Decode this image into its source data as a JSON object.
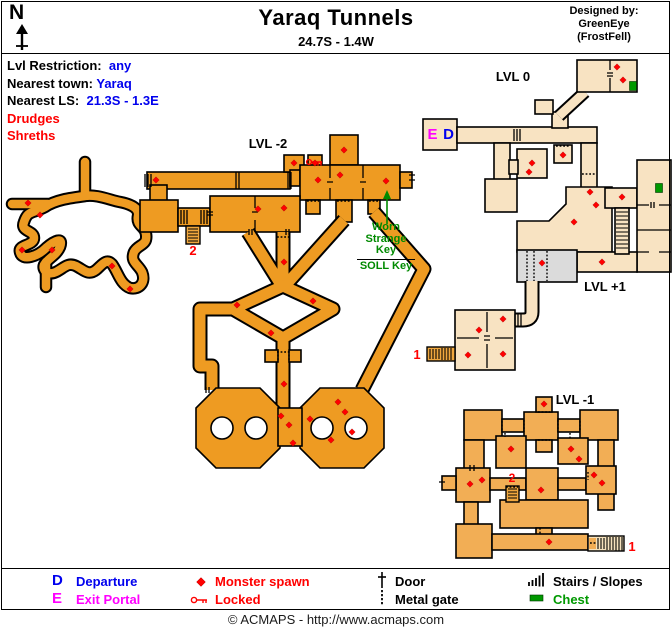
{
  "header": {
    "compass_n": "N",
    "title": "Yaraq Tunnels",
    "coordinates": "24.7S - 1.4W",
    "designed_by": "Designed by:",
    "designer_name": "GreenEye",
    "designer_world": "(FrostFell)"
  },
  "info": {
    "lvl_restriction_label": "Lvl Restriction:",
    "lvl_restriction_value": "any",
    "nearest_town_label": "Nearest town:",
    "nearest_town_value": "Yaraq",
    "nearest_ls_label": "Nearest LS:",
    "nearest_ls_value": "21.3S - 1.3E",
    "monsters": [
      "Drudges",
      "Shreths"
    ]
  },
  "map": {
    "level_labels": {
      "minus2": "LVL -2",
      "zero": "LVL 0",
      "plus1": "LVL +1",
      "minus1": "LVL -1"
    },
    "markers": {
      "exit_portal": "E",
      "departure": "D",
      "stairs_2_upper": "2",
      "stairs_1_upper": "1",
      "stairs_2_lower": "2",
      "stairs_1_lower": "1"
    },
    "key_note": {
      "line1": "Worn",
      "line2": "Strange",
      "line3": "Key",
      "alt": "SOLL Key"
    },
    "monster_spawns": [
      [
        28,
        203
      ],
      [
        40,
        215
      ],
      [
        22,
        250
      ],
      [
        52,
        250
      ],
      [
        112,
        266
      ],
      [
        130,
        289
      ],
      [
        156,
        180
      ],
      [
        294,
        163
      ],
      [
        315,
        163
      ],
      [
        344,
        150
      ],
      [
        318,
        180
      ],
      [
        340,
        175
      ],
      [
        386,
        181
      ],
      [
        258,
        209
      ],
      [
        284,
        208
      ],
      [
        284,
        262
      ],
      [
        237,
        305
      ],
      [
        313,
        301
      ],
      [
        271,
        333
      ],
      [
        284,
        384
      ],
      [
        281,
        416
      ],
      [
        289,
        425
      ],
      [
        293,
        443
      ],
      [
        310,
        419
      ],
      [
        338,
        402
      ],
      [
        345,
        412
      ],
      [
        331,
        440
      ],
      [
        352,
        432
      ],
      [
        532,
        163
      ],
      [
        529,
        172
      ],
      [
        563,
        155
      ],
      [
        617,
        67
      ],
      [
        623,
        80
      ],
      [
        590,
        192
      ],
      [
        596,
        205
      ],
      [
        574,
        222
      ],
      [
        622,
        197
      ],
      [
        542,
        263
      ],
      [
        602,
        262
      ],
      [
        479,
        330
      ],
      [
        503,
        319
      ],
      [
        468,
        355
      ],
      [
        503,
        354
      ],
      [
        544,
        404
      ],
      [
        511,
        449
      ],
      [
        571,
        449
      ],
      [
        579,
        459
      ],
      [
        470,
        484
      ],
      [
        482,
        480
      ],
      [
        541,
        490
      ],
      [
        549,
        542
      ],
      [
        594,
        475
      ],
      [
        602,
        483
      ]
    ],
    "chests": [
      [
        633,
        86
      ],
      [
        659,
        188
      ]
    ]
  },
  "legend": {
    "departure_symbol": "D",
    "departure_label": "Departure",
    "exit_symbol": "E",
    "exit_label": "Exit Portal",
    "monster_spawn_label": "Monster spawn",
    "locked_label": "Locked",
    "door_label": "Door",
    "metal_gate_label": "Metal gate",
    "stairs_label": "Stairs / Slopes",
    "chest_label": "Chest"
  },
  "footer": {
    "copyright": "© ACMAPS - http://www.acmaps.com"
  },
  "colors": {
    "lvl_minus2_orange": "#EE9B22",
    "lvl_minus1_orange": "#F2AE55",
    "lvl0_cream": "#F8E3C2",
    "lvl_plus1_gray": "#DBDBDB",
    "stairs_orange": "#F0A73E",
    "stairs_cream": "#F6E2BD",
    "monster_spawn_red": "#FF0000",
    "departure_blue": "#0000EE",
    "exit_portal_magenta": "#FF00FF",
    "chest_green": "#009900",
    "key_note_green": "#008A00",
    "locked_red": "#FF0000",
    "info_value_blue": "#0000EE"
  }
}
